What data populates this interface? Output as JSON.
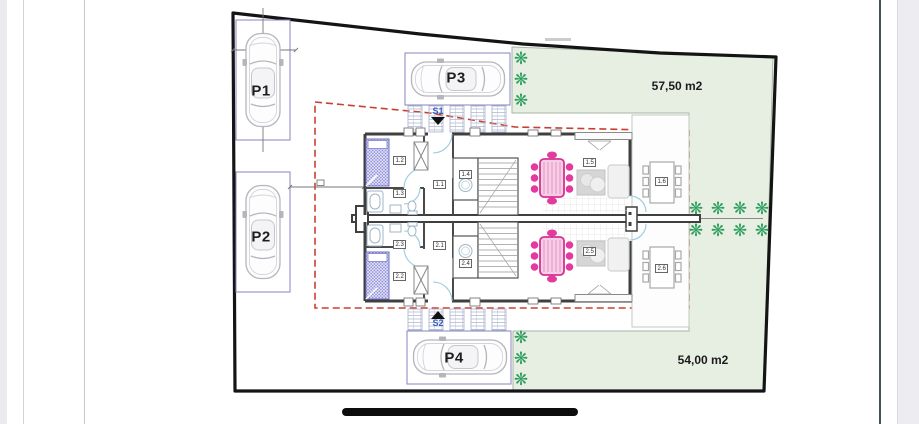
{
  "plan": {
    "green_areas": {
      "top": {
        "label": "57,50 m2"
      },
      "bottom": {
        "label": "54,00 m2"
      }
    },
    "parking": {
      "p1": {
        "label": "P1"
      },
      "p2": {
        "label": "P2"
      },
      "p3": {
        "label": "P3"
      },
      "p4": {
        "label": "P4"
      }
    },
    "entrances": {
      "s1": {
        "label": "S1"
      },
      "s2": {
        "label": "S2"
      }
    },
    "unit1": {
      "rooms": {
        "r1": {
          "label": "1.1"
        },
        "r2": {
          "label": "1.2"
        },
        "r3": {
          "label": "1.3"
        },
        "r4": {
          "label": "1.4"
        },
        "r5": {
          "label": "1.5"
        },
        "r6": {
          "label": "1.6"
        }
      }
    },
    "unit2": {
      "rooms": {
        "r1": {
          "label": "2.1"
        },
        "r2": {
          "label": "2.2"
        },
        "r3": {
          "label": "2.3"
        },
        "r4": {
          "label": "2.4"
        },
        "r5": {
          "label": "2.5"
        },
        "r6": {
          "label": "2.6"
        }
      }
    }
  },
  "icons": {
    "tree_glyph": "❋"
  },
  "colors": {
    "green_fill": "#e7efe3",
    "tree_green": "#2f9e5f",
    "accent_pink": "#e23a9d",
    "boundary_red": "#c8402f",
    "parking_blue": "#8486c0",
    "wall_dark": "#3f3f3f"
  }
}
